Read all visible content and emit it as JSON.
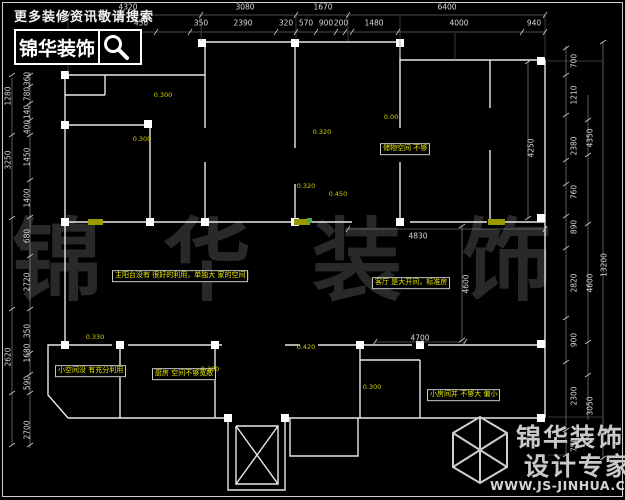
{
  "header": {
    "tagline": "更多装修资讯敬请搜索",
    "brand": "锦华装饰"
  },
  "watermark": "锦华装饰",
  "footer": {
    "brand_top": "锦华装饰",
    "brand_bottom": "设计专家",
    "website": "WWW.JS-JINHUA.COM"
  },
  "colors": {
    "background": "#000000",
    "walls": "#e8e8e8",
    "dimension_text": "#d9d9d9",
    "note_text": "#e8e800",
    "window_marker": "#9a9a00",
    "watermark": "rgba(255,255,255,0.16)"
  },
  "plan": {
    "dimensions": {
      "top_row1": [
        {
          "text": "4320",
          "x": 128,
          "y": 7
        },
        {
          "text": "3080",
          "x": 245,
          "y": 7
        },
        {
          "text": "1670",
          "x": 323,
          "y": 7
        },
        {
          "text": "6400",
          "x": 447,
          "y": 7
        }
      ],
      "top_row2": [
        {
          "text": "450",
          "x": 141,
          "y": 23
        },
        {
          "text": "350",
          "x": 201,
          "y": 23
        },
        {
          "text": "2390",
          "x": 243,
          "y": 23
        },
        {
          "text": "320",
          "x": 286,
          "y": 23
        },
        {
          "text": "570",
          "x": 306,
          "y": 23
        },
        {
          "text": "900",
          "x": 326,
          "y": 23
        },
        {
          "text": "200",
          "x": 341,
          "y": 23
        },
        {
          "text": "1480",
          "x": 374,
          "y": 23
        },
        {
          "text": "4000",
          "x": 459,
          "y": 23
        },
        {
          "text": "940",
          "x": 534,
          "y": 23
        }
      ],
      "left_inner": [
        {
          "text": "360",
          "x": 27,
          "y": 79
        },
        {
          "text": "780",
          "x": 27,
          "y": 94
        },
        {
          "text": "140",
          "x": 27,
          "y": 112
        },
        {
          "text": "400",
          "x": 27,
          "y": 127
        },
        {
          "text": "1450",
          "x": 27,
          "y": 157
        },
        {
          "text": "1400",
          "x": 27,
          "y": 198
        },
        {
          "text": "680",
          "x": 27,
          "y": 236
        },
        {
          "text": "2720",
          "x": 27,
          "y": 282
        },
        {
          "text": "350",
          "x": 27,
          "y": 331
        },
        {
          "text": "1680",
          "x": 27,
          "y": 353
        },
        {
          "text": "590",
          "x": 27,
          "y": 383
        },
        {
          "text": "2700",
          "x": 27,
          "y": 430
        }
      ],
      "left_outer": [
        {
          "text": "1280",
          "x": 8,
          "y": 96
        },
        {
          "text": "3250",
          "x": 8,
          "y": 160
        },
        {
          "text": "2620",
          "x": 8,
          "y": 357
        }
      ],
      "right_inner": [
        {
          "text": "700",
          "x": 574,
          "y": 61
        },
        {
          "text": "1210",
          "x": 574,
          "y": 95
        },
        {
          "text": "2380",
          "x": 574,
          "y": 146
        },
        {
          "text": "760",
          "x": 574,
          "y": 192
        },
        {
          "text": "890",
          "x": 574,
          "y": 227
        },
        {
          "text": "2820",
          "x": 574,
          "y": 283
        },
        {
          "text": "900",
          "x": 574,
          "y": 340
        },
        {
          "text": "2300",
          "x": 574,
          "y": 396
        },
        {
          "text": "750",
          "x": 574,
          "y": 445
        }
      ],
      "right_mid": [
        {
          "text": "4350",
          "x": 590,
          "y": 138
        },
        {
          "text": "4600",
          "x": 590,
          "y": 283
        },
        {
          "text": "3050",
          "x": 590,
          "y": 406
        }
      ],
      "right_outer": [
        {
          "text": "13200",
          "x": 604,
          "y": 265
        }
      ],
      "inner_h": [
        {
          "text": "4830",
          "x": 418,
          "y": 236
        },
        {
          "text": "4700",
          "x": 420,
          "y": 338
        }
      ],
      "inner_v": [
        {
          "text": "4250",
          "x": 531,
          "y": 148
        },
        {
          "text": "4600",
          "x": 466,
          "y": 284
        }
      ]
    },
    "room_notes": [
      {
        "text": "主阳台没有 很好的利用，单独大 家的空间",
        "x": 112,
        "y": 276
      },
      {
        "text": "客厅 是大开间，标准房",
        "x": 372,
        "y": 283
      },
      {
        "text": "储物空间 不够",
        "x": 380,
        "y": 149
      },
      {
        "text": "小空间没 有充分利用",
        "x": 55,
        "y": 371
      },
      {
        "text": "厨房 空间不够宽敞",
        "x": 152,
        "y": 374
      },
      {
        "text": "小房间并 不够大 偏小",
        "x": 427,
        "y": 395
      }
    ],
    "elevation_marks": [
      {
        "text": "0.300",
        "x": 163,
        "y": 95
      },
      {
        "text": "0.300",
        "x": 142,
        "y": 139
      },
      {
        "text": "0.320",
        "x": 322,
        "y": 132
      },
      {
        "text": "0.00",
        "x": 391,
        "y": 117
      },
      {
        "text": "0.320",
        "x": 306,
        "y": 186
      },
      {
        "text": "0.450",
        "x": 338,
        "y": 194
      },
      {
        "text": "0.330",
        "x": 95,
        "y": 337
      },
      {
        "text": "0.420",
        "x": 306,
        "y": 347
      },
      {
        "text": "0.300",
        "x": 210,
        "y": 369
      },
      {
        "text": "0.300",
        "x": 372,
        "y": 387
      }
    ]
  }
}
